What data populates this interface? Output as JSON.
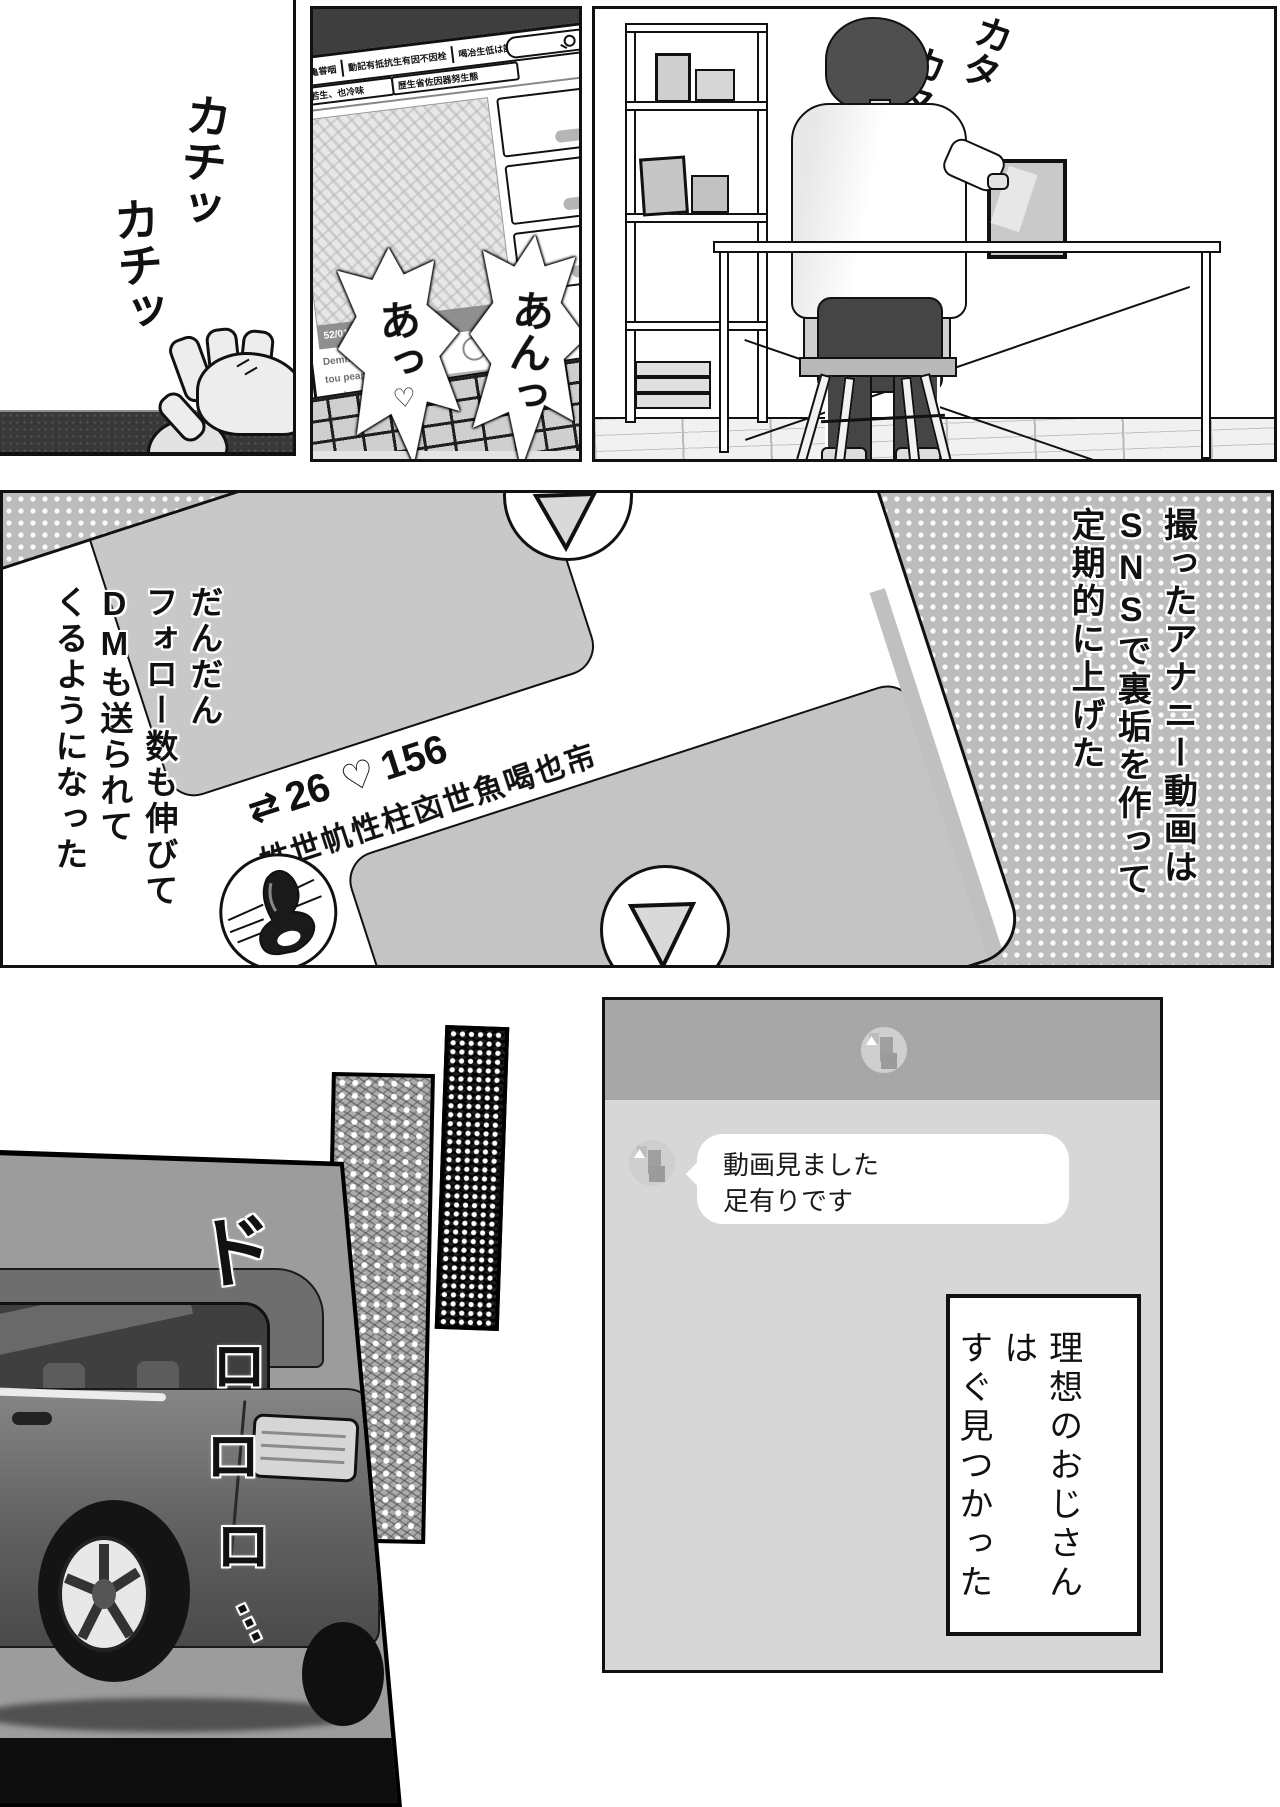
{
  "page": {
    "width": 1280,
    "height": 1807,
    "colors": {
      "ink": "#111111",
      "paper": "#ffffff",
      "halftone_gray": "#bcbcbc",
      "chat_header": "#a7a7a7",
      "chat_body": "#d7d7d7",
      "dark_wall": "#3e3e3e"
    }
  },
  "panel_mouse": {
    "sfx_click_1": "カチッ",
    "sfx_click_2": "カチッ"
  },
  "panel_laptop": {
    "sfx_moan_1": "あっ",
    "sfx_moan_1_heart": "♡",
    "sfx_moan_2": "あんっ",
    "screen": {
      "menu_scribbles": [
        "冑促生亀甞咽",
        "動記有抵抗生有因不因栓",
        "喝冶生低は記喝",
        "健魚もも"
      ],
      "tab_scribbles": [
        "幟記若生、也冷味",
        "歴生省佐因器努生態"
      ],
      "time_label": "52/017:19",
      "comment_scribbles": [
        "Demmiere Cash to et fot",
        "tou peapeth D――",
        "ma jeep――"
      ]
    }
  },
  "panel_desk": {
    "sfx_typing_1": "カタ",
    "sfx_typing_2": "カタ"
  },
  "panel_sns": {
    "narration_right": {
      "col1": "撮ったアナニー動画は",
      "col2": "SNSで裏垢を作って",
      "col3": "定期的に上げた"
    },
    "narration_left": {
      "col1": "だんだん",
      "col2": "フォロー数も伸びて",
      "col3": "DMも送られて",
      "col4": "くるようになった"
    },
    "post": {
      "retweet_icon": "⇄",
      "retweet_count": "26",
      "like_icon": "♡",
      "like_count": "156",
      "username_scribble": "姓世㠶性柱㐫世魚喝也㠵"
    }
  },
  "panel_chat": {
    "message_line_1": "動画見ました",
    "message_line_2": "足有りです",
    "narration_box": {
      "col1": "理想のおじさんは",
      "col2": "すぐ見つかった"
    }
  },
  "panel_car": {
    "sfx_engine": [
      "ド",
      "ロ",
      "ロ",
      "ロ",
      "…"
    ]
  }
}
